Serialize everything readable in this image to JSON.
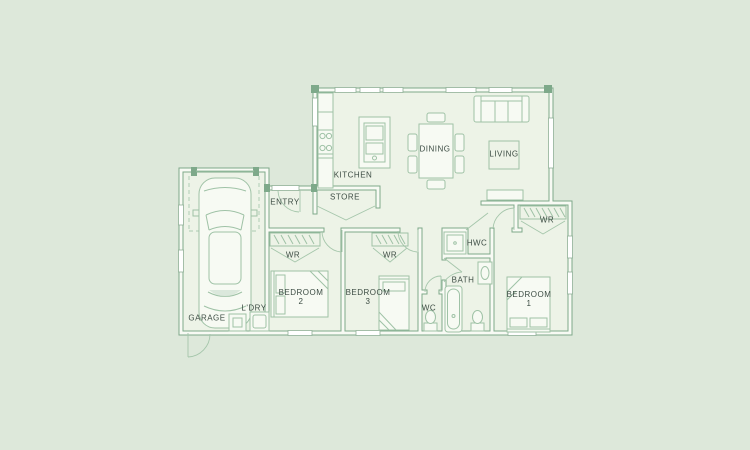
{
  "labels": {
    "garage": "GARAGE",
    "ldry": "L'DRY",
    "entry": "ENTRY",
    "kitchen": "KITCHEN",
    "store": "STORE",
    "dining": "DINING",
    "living": "LIVING",
    "wr_bedroom2": "WR",
    "wr_bedroom3": "WR",
    "wr_bedroom1": "WR",
    "hwc": "HWC",
    "bath": "BATH",
    "wc": "WC"
  },
  "rooms": {
    "bedroom2": {
      "line1": "BEDROOM",
      "line2": "2"
    },
    "bedroom3": {
      "line1": "BEDROOM",
      "line2": "3"
    },
    "bedroom1": {
      "line1": "BEDROOM",
      "line2": "1"
    }
  },
  "fixtures": [
    "car",
    "sofa",
    "rug",
    "television-unit",
    "dining-table",
    "dining-chairs",
    "kitchen-island-sink",
    "kitchen-counter",
    "cooktop",
    "store-double-doors",
    "wardrobe-rails",
    "double-bed",
    "single-bed",
    "shower",
    "bathtub",
    "vanity-basin",
    "toilet",
    "washing-machine",
    "laundry-tub",
    "hot-water-cylinder"
  ],
  "colors": {
    "background": "#dde8da",
    "floor": "#edf3e7",
    "wall_line": "#7ea98a",
    "wall_core": "#f8faf4",
    "furniture_line": "#9fc2a6",
    "dashed_line": "#b9d3bd",
    "label_text": "#3d4d44"
  }
}
